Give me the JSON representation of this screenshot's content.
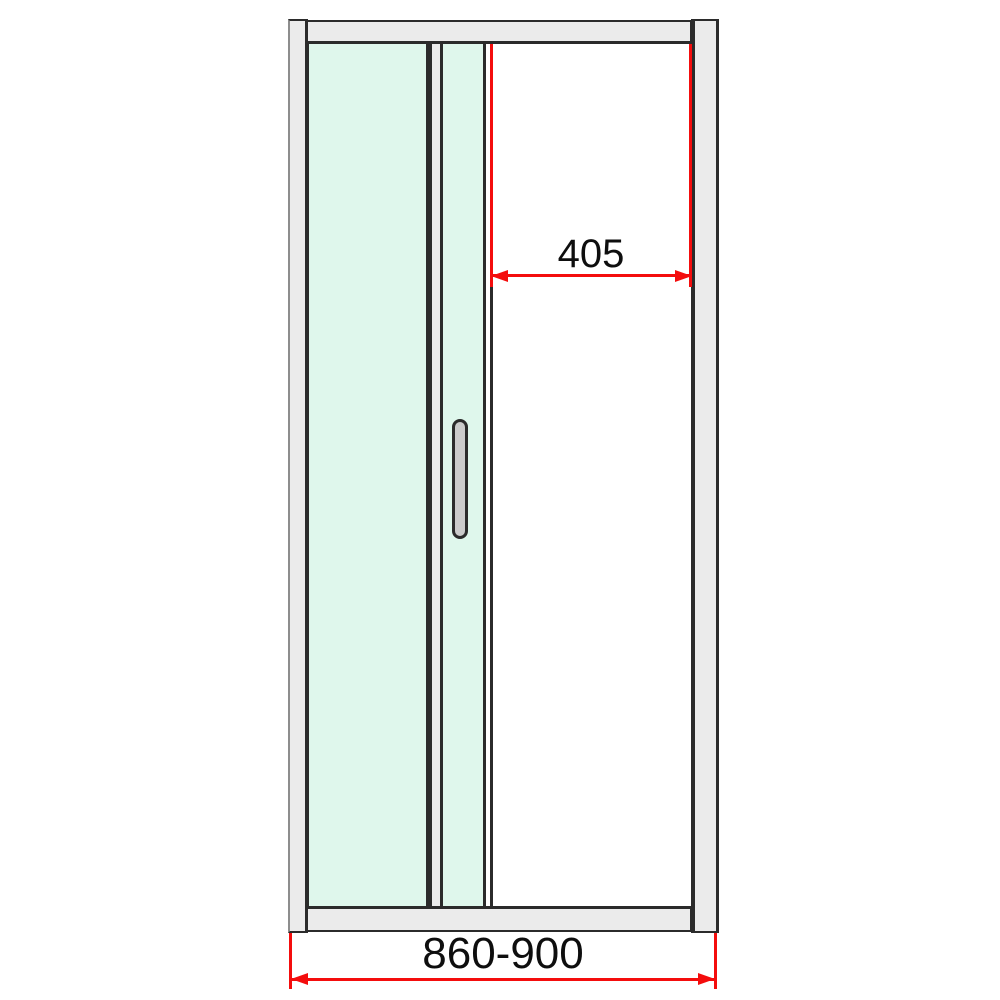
{
  "diagram": {
    "title": "Sliding shower door technical drawing",
    "dimensions": {
      "opening": {
        "label": "405"
      },
      "overall": {
        "label": "860-900"
      }
    },
    "colors": {
      "background": "#ffffff",
      "frame_fill": "#ebebeb",
      "outline": "#2b2b2b",
      "glass_fill": "#dff7ec",
      "handle_fill": "#cbcbcb",
      "dimension_red": "#f40d0d",
      "label_text": "#0e0e0e"
    }
  }
}
